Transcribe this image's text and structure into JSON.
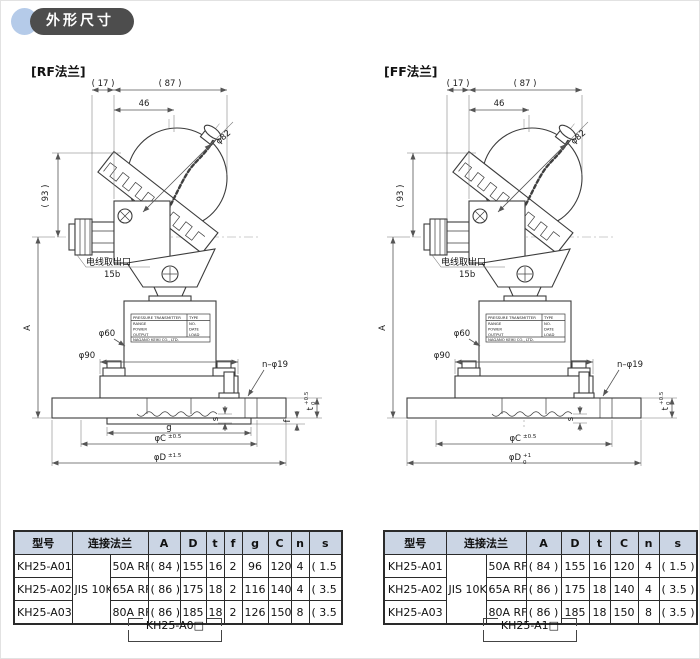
{
  "header": {
    "title": "外形尺寸"
  },
  "shared": {
    "w17": "( 17 )",
    "w87": "( 87 )",
    "w46": "46",
    "phi82": "φ82",
    "h93": "( 93 )",
    "A": "A",
    "wire_outlet": "电线取出口",
    "wire_size": "15b",
    "phi60": "φ60",
    "phi90": "φ90",
    "n_phi19": "n–φ19",
    "s": "s",
    "t": "t",
    "t_sup": "+0.5",
    "t_sub": "0",
    "phiC": "φC",
    "phiC_tol": "±0.5"
  },
  "nameplate": {
    "l1a": "PRESSURE TRANSMITTER",
    "l1b": "TYPE",
    "l2a": "RANGE",
    "l2b": "NO.",
    "l3a": "POWER",
    "l3b": "DATE",
    "l4a": "OUTPUT",
    "l4b": "LOAD",
    "l5": "NAGANO KEIKI CO., LTD."
  },
  "rf": {
    "label": "[RF法兰]",
    "g": "g",
    "f": "f",
    "phiD": "φD",
    "phiD_tol": "±1.5",
    "footer_model": "KH25-A0□"
  },
  "ff": {
    "label": "[FF法兰]",
    "phiD": "φD",
    "phiD_sup": "+1",
    "phiD_sub": "0",
    "footer_model": "KH25-A1□"
  },
  "tables": {
    "rf": {
      "headers": [
        "型号",
        "连接法兰",
        "A",
        "D",
        "t",
        "f",
        "g",
        "C",
        "n",
        "s"
      ],
      "flange_std": "JIS 10K",
      "rows": [
        {
          "model": "KH25-A01",
          "flange": "50A RF",
          "A": "( 84 )",
          "D": "155",
          "t": "16",
          "f": "2",
          "g": "96",
          "C": "120",
          "n": "4",
          "s": "( 1.5 )"
        },
        {
          "model": "KH25-A02",
          "flange": "65A RF",
          "A": "( 86 )",
          "D": "175",
          "t": "18",
          "f": "2",
          "g": "116",
          "C": "140",
          "n": "4",
          "s": "( 3.5 )"
        },
        {
          "model": "KH25-A03",
          "flange": "80A RF",
          "A": "( 86 )",
          "D": "185",
          "t": "18",
          "f": "2",
          "g": "126",
          "C": "150",
          "n": "8",
          "s": "( 3.5 )"
        }
      ]
    },
    "ff": {
      "headers": [
        "型号",
        "连接法兰",
        "A",
        "D",
        "t",
        "C",
        "n",
        "s"
      ],
      "flange_std": "JIS 10K",
      "rows": [
        {
          "model": "KH25-A01",
          "flange": "50A RF",
          "A": "( 84 )",
          "D": "155",
          "t": "16",
          "C": "120",
          "n": "4",
          "s": "( 1.5 )"
        },
        {
          "model": "KH25-A02",
          "flange": "65A RF",
          "A": "( 86 )",
          "D": "175",
          "t": "18",
          "C": "140",
          "n": "4",
          "s": "( 3.5 )"
        },
        {
          "model": "KH25-A03",
          "flange": "80A RF",
          "A": "( 86 )",
          "D": "185",
          "t": "18",
          "C": "150",
          "n": "8",
          "s": "( 3.5 )"
        }
      ]
    }
  }
}
